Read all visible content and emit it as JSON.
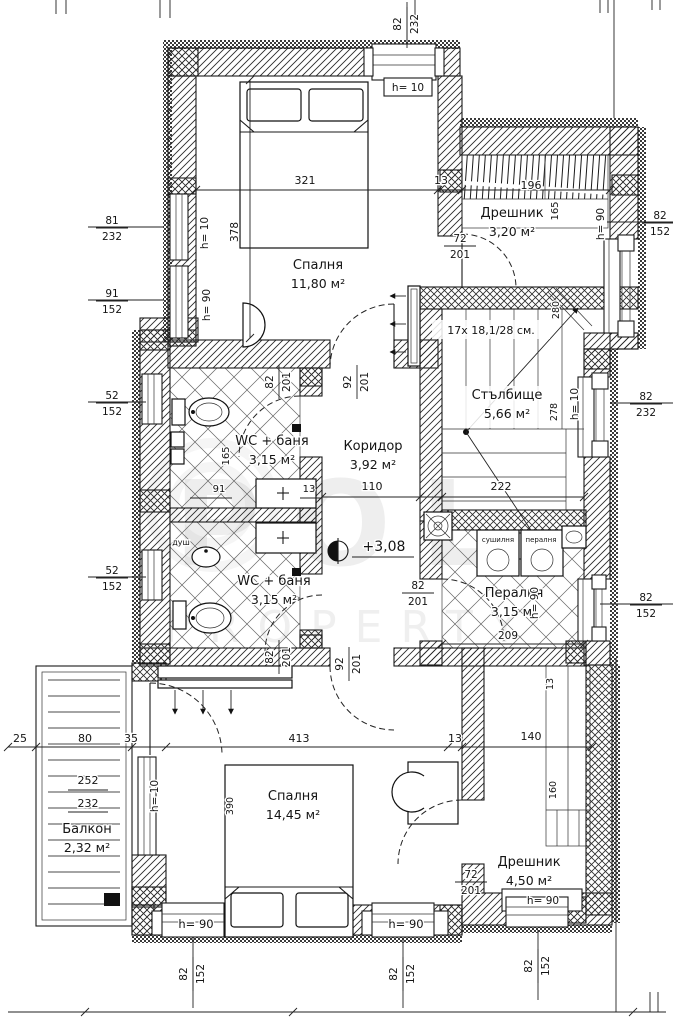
{
  "watermark": {
    "line1": "POL",
    "line2": "PROPERTY"
  },
  "level_mark": "+3,08",
  "stairs_spec": "17x 18,1/28 см.",
  "rooms": [
    {
      "id": "bedroom-top",
      "name": "Спалня",
      "area": "11,80 м²",
      "cx": 318,
      "cy": 269
    },
    {
      "id": "wardrobe-top",
      "name": "Дрешник",
      "area": "3,20 м²",
      "cx": 512,
      "cy": 217
    },
    {
      "id": "staircase",
      "name": "Стълбище",
      "area": "5,66 м²",
      "cx": 507,
      "cy": 399
    },
    {
      "id": "corridor",
      "name": "Коридор",
      "area": "3,92 м²",
      "cx": 373,
      "cy": 450
    },
    {
      "id": "wc-bath-upper",
      "name": "WC + баня",
      "area": "3,15 м²",
      "cx": 272,
      "cy": 445
    },
    {
      "id": "wc-bath-lower",
      "name": "WC + баня",
      "area": "3,15 м²",
      "cx": 274,
      "cy": 585
    },
    {
      "id": "laundry",
      "name": "Пералня",
      "area": "3,15 м²",
      "cx": 514,
      "cy": 597
    },
    {
      "id": "bedroom-bottom",
      "name": "Спалня",
      "area": "14,45 м²",
      "cx": 293,
      "cy": 800
    },
    {
      "id": "wardrobe-bottom",
      "name": "Дрешник",
      "area": "4,50 м²",
      "cx": 529,
      "cy": 866
    },
    {
      "id": "balcony",
      "name": "Балкон",
      "area": "2,32 м²",
      "cx": 87,
      "cy": 833
    }
  ],
  "labels": [
    {
      "id": "stairs-spec",
      "k": "t",
      "t": "17x 18,1/28 см.",
      "x": 491,
      "y": 334,
      "s": 11
    },
    {
      "id": "level-value",
      "k": "t",
      "t": "+3,08",
      "x": 384,
      "y": 551,
      "s": 14
    },
    {
      "id": "dim-321",
      "k": "t",
      "t": "321",
      "x": 305,
      "y": 184,
      "s": 11
    },
    {
      "id": "dim-13-top",
      "k": "t",
      "t": "13",
      "x": 441,
      "y": 184,
      "s": 11
    },
    {
      "id": "dim-196",
      "k": "t",
      "t": "196",
      "x": 531,
      "y": 189,
      "s": 11
    },
    {
      "id": "dim-110",
      "k": "t",
      "t": "110",
      "x": 372,
      "y": 490,
      "s": 11
    },
    {
      "id": "dim-222",
      "k": "t",
      "t": "222",
      "x": 501,
      "y": 490,
      "s": 11
    },
    {
      "id": "dim-91",
      "k": "t",
      "t": "91",
      "x": 219,
      "y": 492,
      "s": 10
    },
    {
      "id": "dim-13-wc",
      "k": "t",
      "t": "13",
      "x": 309,
      "y": 492,
      "s": 10
    },
    {
      "id": "dim-209",
      "k": "t",
      "t": "209",
      "x": 508,
      "y": 639,
      "s": 10.5
    },
    {
      "id": "dim-25",
      "k": "t",
      "t": "25",
      "x": 20,
      "y": 742,
      "s": 11
    },
    {
      "id": "dim-80",
      "k": "t",
      "t": "80",
      "x": 85,
      "y": 742,
      "s": 11
    },
    {
      "id": "dim-35",
      "k": "t",
      "t": "35",
      "x": 131,
      "y": 742,
      "s": 11
    },
    {
      "id": "dim-413",
      "k": "t",
      "t": "413",
      "x": 299,
      "y": 742,
      "s": 11
    },
    {
      "id": "dim-13-bottom",
      "k": "t",
      "t": "13",
      "x": 455,
      "y": 742,
      "s": 11
    },
    {
      "id": "dim-140",
      "k": "t",
      "t": "140",
      "x": 531,
      "y": 740,
      "s": 11
    },
    {
      "id": "dim-252",
      "k": "t",
      "t": "252",
      "x": 88,
      "y": 784,
      "s": 11
    },
    {
      "id": "dim-232-balcony",
      "k": "t",
      "t": "232",
      "x": 88,
      "y": 807,
      "s": 11
    },
    {
      "id": "h10-top-window",
      "k": "t",
      "t": "h= 10",
      "x": 408,
      "y": 91,
      "s": 10.5
    },
    {
      "id": "h90-bottom-window-1",
      "k": "t",
      "t": "h= 90",
      "x": 196,
      "y": 928,
      "s": 11.5
    },
    {
      "id": "h90-bottom-window-2",
      "k": "t",
      "t": "h= 90",
      "x": 406,
      "y": 928,
      "s": 11.5
    },
    {
      "id": "h90-closet-window",
      "k": "t",
      "t": "h= 90",
      "x": 543,
      "y": 904,
      "s": 10.5
    },
    {
      "id": "appliance-dryer",
      "k": "t",
      "t": "сушилня",
      "x": 498,
      "y": 542,
      "s": 7
    },
    {
      "id": "appliance-washer",
      "k": "t",
      "t": "пералня",
      "x": 541,
      "y": 542,
      "s": 7
    },
    {
      "id": "shower-label",
      "k": "t",
      "t": "душ",
      "x": 181,
      "y": 545,
      "s": 8
    },
    {
      "id": "dim-378",
      "k": "t",
      "t": "378",
      "x": 238,
      "y": 232,
      "s": 10.5,
      "r": 1
    },
    {
      "id": "h10-left-window",
      "k": "t",
      "t": "h= 10",
      "x": 208,
      "y": 233,
      "s": 10.5,
      "r": 1
    },
    {
      "id": "h90-left-window",
      "k": "t",
      "t": "h= 90",
      "x": 210,
      "y": 305,
      "s": 10.5,
      "r": 1
    },
    {
      "id": "dim-165-closet",
      "k": "t",
      "t": "165",
      "x": 558,
      "y": 211,
      "s": 10,
      "r": 1
    },
    {
      "id": "h90-wardrobe-window",
      "k": "t",
      "t": "h= 90",
      "x": 604,
      "y": 224,
      "s": 10.5,
      "r": 1
    },
    {
      "id": "dim-280",
      "k": "t",
      "t": "280",
      "x": 559,
      "y": 310,
      "s": 9.5,
      "r": 1
    },
    {
      "id": "dim-278",
      "k": "t",
      "t": "278",
      "x": 557,
      "y": 412,
      "s": 9.5,
      "r": 1
    },
    {
      "id": "h10-stairs-window",
      "k": "t",
      "t": "h= 10",
      "x": 578,
      "y": 404,
      "s": 10.5,
      "r": 1
    },
    {
      "id": "dim-165-bath",
      "k": "t",
      "t": "165",
      "x": 229,
      "y": 456,
      "s": 10,
      "r": 1
    },
    {
      "id": "h90-laundry-window",
      "k": "t",
      "t": "h= 90",
      "x": 538,
      "y": 603,
      "s": 10.5,
      "r": 1
    },
    {
      "id": "h10-balcony-door",
      "k": "t",
      "t": "h= 10",
      "x": 158,
      "y": 796,
      "s": 10.5,
      "r": 1
    },
    {
      "id": "dim-390",
      "k": "t",
      "t": "390",
      "x": 233,
      "y": 806,
      "s": 9.5,
      "r": 1
    },
    {
      "id": "dim-160",
      "k": "t",
      "t": "160",
      "x": 556,
      "y": 790,
      "s": 9.5,
      "r": 1
    },
    {
      "id": "dim-13-closet",
      "k": "t",
      "t": "13",
      "x": 553,
      "y": 684,
      "s": 9.5,
      "r": 1
    },
    {
      "id": "dim-81-232",
      "k": "f",
      "a": "81",
      "b": "232",
      "x": 112,
      "y": 227
    },
    {
      "id": "dim-91-152",
      "k": "f",
      "a": "91",
      "b": "152",
      "x": 112,
      "y": 300
    },
    {
      "id": "dim-52-152-upper",
      "k": "f",
      "a": "52",
      "b": "152",
      "x": 112,
      "y": 402
    },
    {
      "id": "dim-52-152-lower",
      "k": "f",
      "a": "52",
      "b": "152",
      "x": 112,
      "y": 577
    },
    {
      "id": "dim-72-201-wardrobe",
      "k": "f",
      "a": "72",
      "b": "201",
      "x": 460,
      "y": 245
    },
    {
      "id": "dim-72-201-closet",
      "k": "f",
      "a": "72",
      "b": "201",
      "x": 471,
      "y": 881
    },
    {
      "id": "dim-82-152-right-top",
      "k": "f",
      "a": "82",
      "b": "152",
      "x": 660,
      "y": 222
    },
    {
      "id": "dim-82-232-right",
      "k": "f",
      "a": "82",
      "b": "232",
      "x": 646,
      "y": 403
    },
    {
      "id": "dim-82-152-right-low",
      "k": "f",
      "a": "82",
      "b": "152",
      "x": 646,
      "y": 604
    },
    {
      "id": "dim-82-201-laundry",
      "k": "f",
      "a": "82",
      "b": "201",
      "x": 418,
      "y": 592
    },
    {
      "id": "dim-82-232-top",
      "k": "vf",
      "a": "82",
      "b": "232",
      "x": 407,
      "y": 24
    },
    {
      "id": "dim-92-201-bed1",
      "k": "vf",
      "a": "92",
      "b": "201",
      "x": 357,
      "y": 382
    },
    {
      "id": "dim-82-201-wc1",
      "k": "vf",
      "a": "82",
      "b": "201",
      "x": 279,
      "y": 382
    },
    {
      "id": "dim-82-201-wc2",
      "k": "vf",
      "a": "82",
      "b": "201",
      "x": 279,
      "y": 657
    },
    {
      "id": "dim-92-201-bed2",
      "k": "vf",
      "a": "92",
      "b": "201",
      "x": 349,
      "y": 664
    },
    {
      "id": "dim-82-152-bw1",
      "k": "vf",
      "a": "82",
      "b": "152",
      "x": 193,
      "y": 974
    },
    {
      "id": "dim-82-152-bw2",
      "k": "vf",
      "a": "82",
      "b": "152",
      "x": 403,
      "y": 974
    },
    {
      "id": "dim-82-152-bw3",
      "k": "vf",
      "a": "82",
      "b": "152",
      "x": 538,
      "y": 966
    }
  ]
}
